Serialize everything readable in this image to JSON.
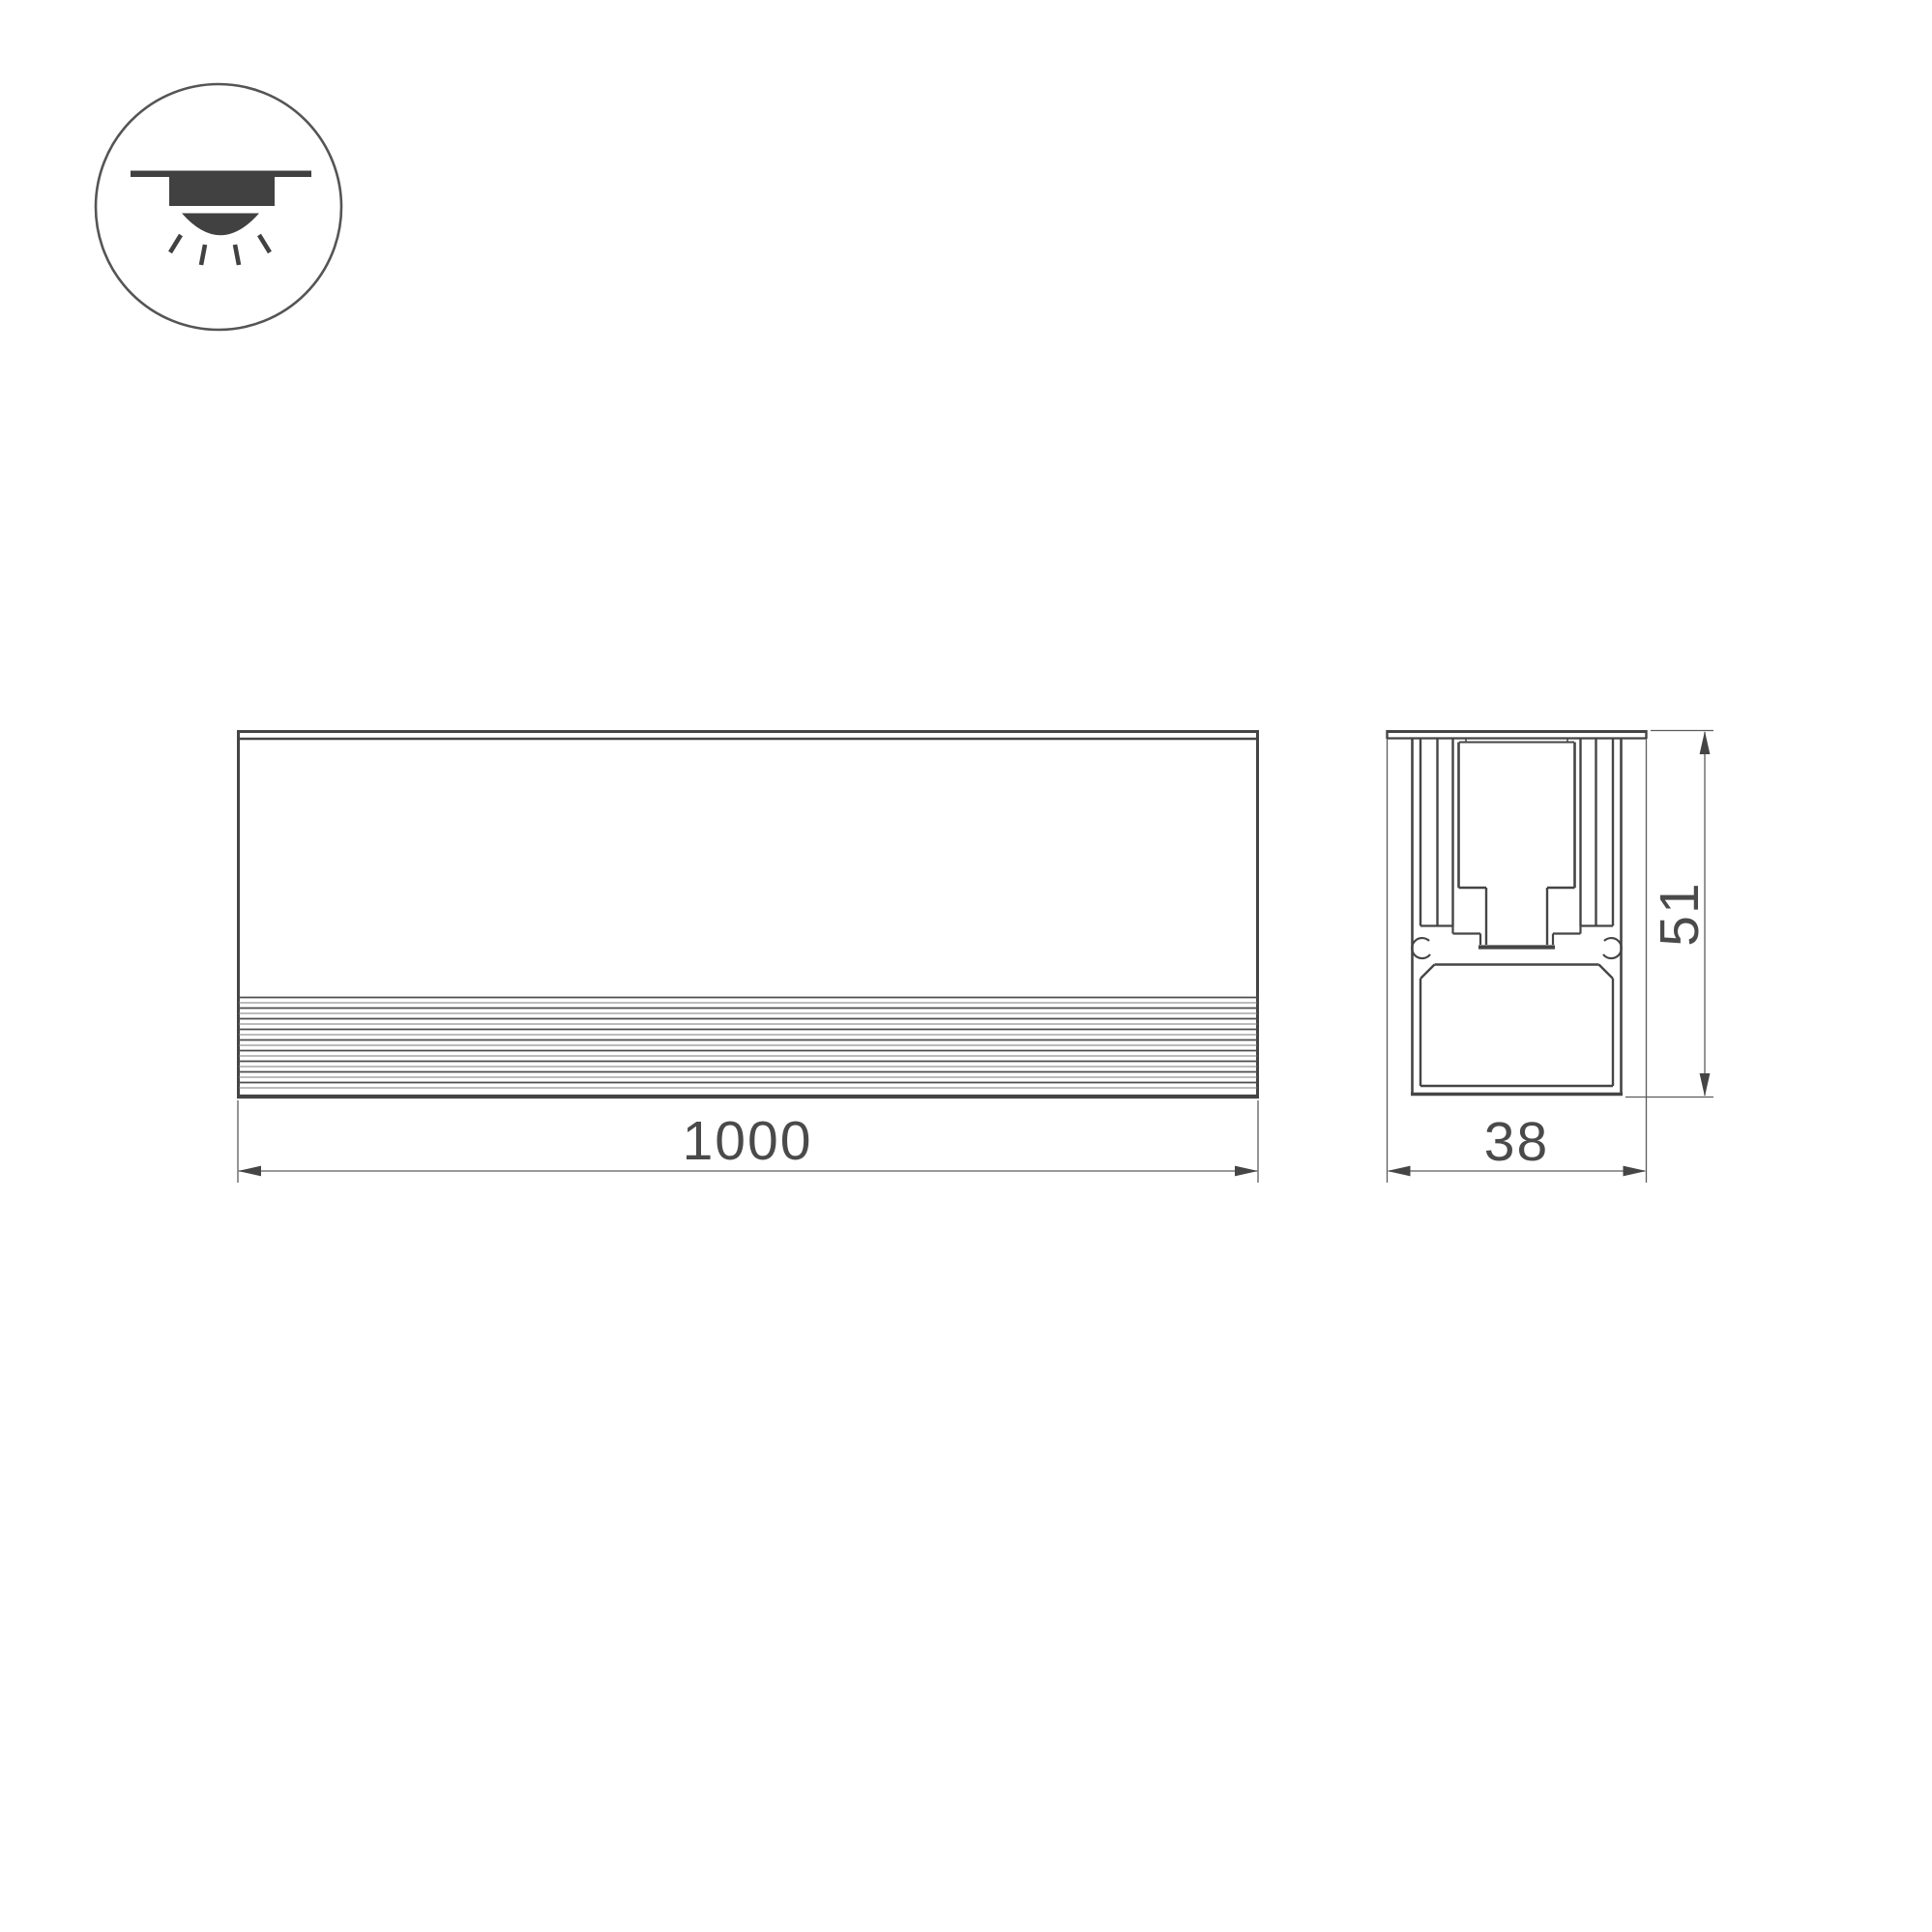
{
  "page": {
    "background": "#ffffff"
  },
  "palette": {
    "line": "#454545",
    "thin_line": "#5c5c5c",
    "text": "#4a4a4a",
    "icon_fill": "#414141"
  },
  "pictogram": {
    "icon": "recessed-ceiling-light-icon"
  },
  "front_view": {
    "length_label": "1000"
  },
  "section_view": {
    "width_label": "38",
    "height_label": "51"
  }
}
